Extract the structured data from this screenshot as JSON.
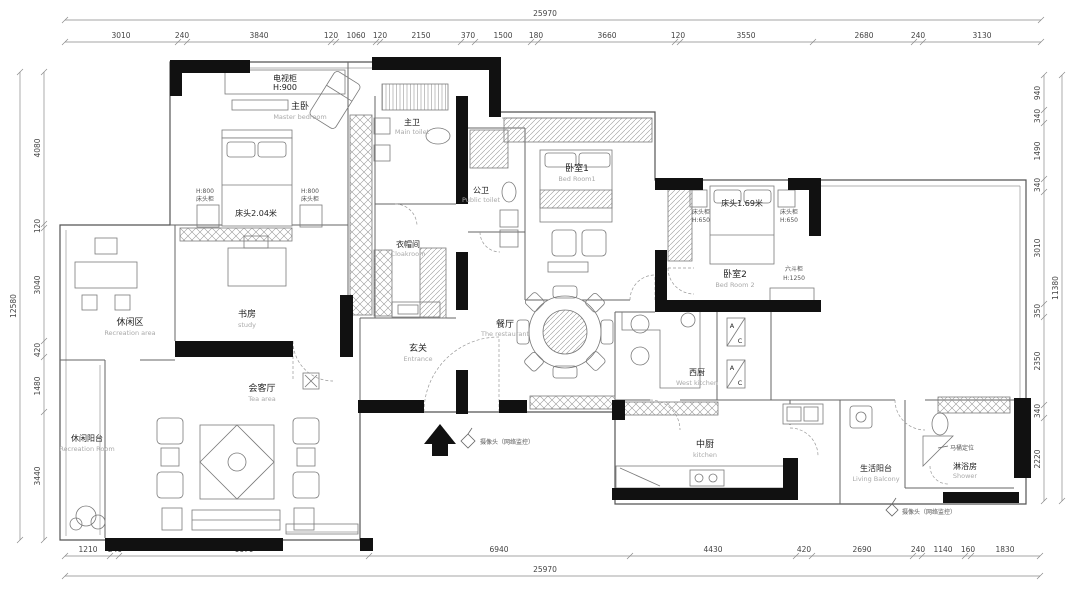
{
  "dims": {
    "top": {
      "total": "25970",
      "segments": [
        "3010",
        "240",
        "3840",
        "120",
        "1060",
        "120",
        "2150",
        "370",
        "1500",
        "180",
        "3660",
        "120",
        "3550",
        "2680",
        "240",
        "3130"
      ]
    },
    "bottom": {
      "total": "25970",
      "segments": [
        "1210",
        "240",
        "6670",
        "6940",
        "4430",
        "420",
        "2690",
        "240",
        "1140",
        "160",
        "1830"
      ]
    },
    "left": {
      "total": "12580",
      "segments": [
        "4080",
        "120",
        "3040",
        "420",
        "1480",
        "3440"
      ]
    },
    "right": {
      "total": "11380",
      "segments": [
        "940",
        "340",
        "1490",
        "340",
        "3010",
        "350",
        "2350",
        "340",
        "2220"
      ]
    }
  },
  "rooms": {
    "master_bedroom": {
      "name": "主卧",
      "sub": "Master bedroom"
    },
    "master_bath": {
      "name": "主卫",
      "sub": "Main toilet"
    },
    "cloakroom": {
      "name": "衣帽间",
      "sub": "Cloakroom"
    },
    "public_bath": {
      "name": "公卫",
      "sub": "Public toilet"
    },
    "bedroom1": {
      "name": "卧室1",
      "sub": "Bed Room1"
    },
    "bedroom2": {
      "name": "卧室2",
      "sub": "Bed Room 2"
    },
    "study": {
      "name": "书房",
      "sub": "study"
    },
    "leisure_area": {
      "name": "休闲区",
      "sub": "Recreation area"
    },
    "tea_room": {
      "name": "会客厅",
      "sub": "Tea area"
    },
    "entrance": {
      "name": "玄关",
      "sub": "Entrance"
    },
    "dining": {
      "name": "餐厅",
      "sub": "The restaurant"
    },
    "west_kitchen": {
      "name": "西厨",
      "sub": "West kitchen"
    },
    "kitchen": {
      "name": "中厨",
      "sub": "kitchen"
    },
    "living_balcony": {
      "name": "生活阳台",
      "sub": "Living Balcony"
    },
    "leisure_balcony": {
      "name": "休闲阳台",
      "sub": "Recreation Room"
    },
    "shower_room": {
      "name": "淋浴房",
      "sub": "Shower"
    }
  },
  "furniture": {
    "tv_cabinet": {
      "name": "电视柜",
      "height": "H:900"
    },
    "master_bed": {
      "size": "床头2.04米"
    },
    "nightstand_master": {
      "height": "H:800",
      "name": "床头柜"
    },
    "bed2": {
      "size": "床头1.69米"
    },
    "nightstand_bed2": {
      "name": "床头柜",
      "height": "H:650"
    },
    "chest": {
      "name": "六斗柜",
      "height": "H:1250"
    },
    "ac_label": {
      "a": "A",
      "c": "C"
    }
  },
  "notes": {
    "camera": "摄像头（网络监控）",
    "toilet_note": "马桶定位"
  }
}
